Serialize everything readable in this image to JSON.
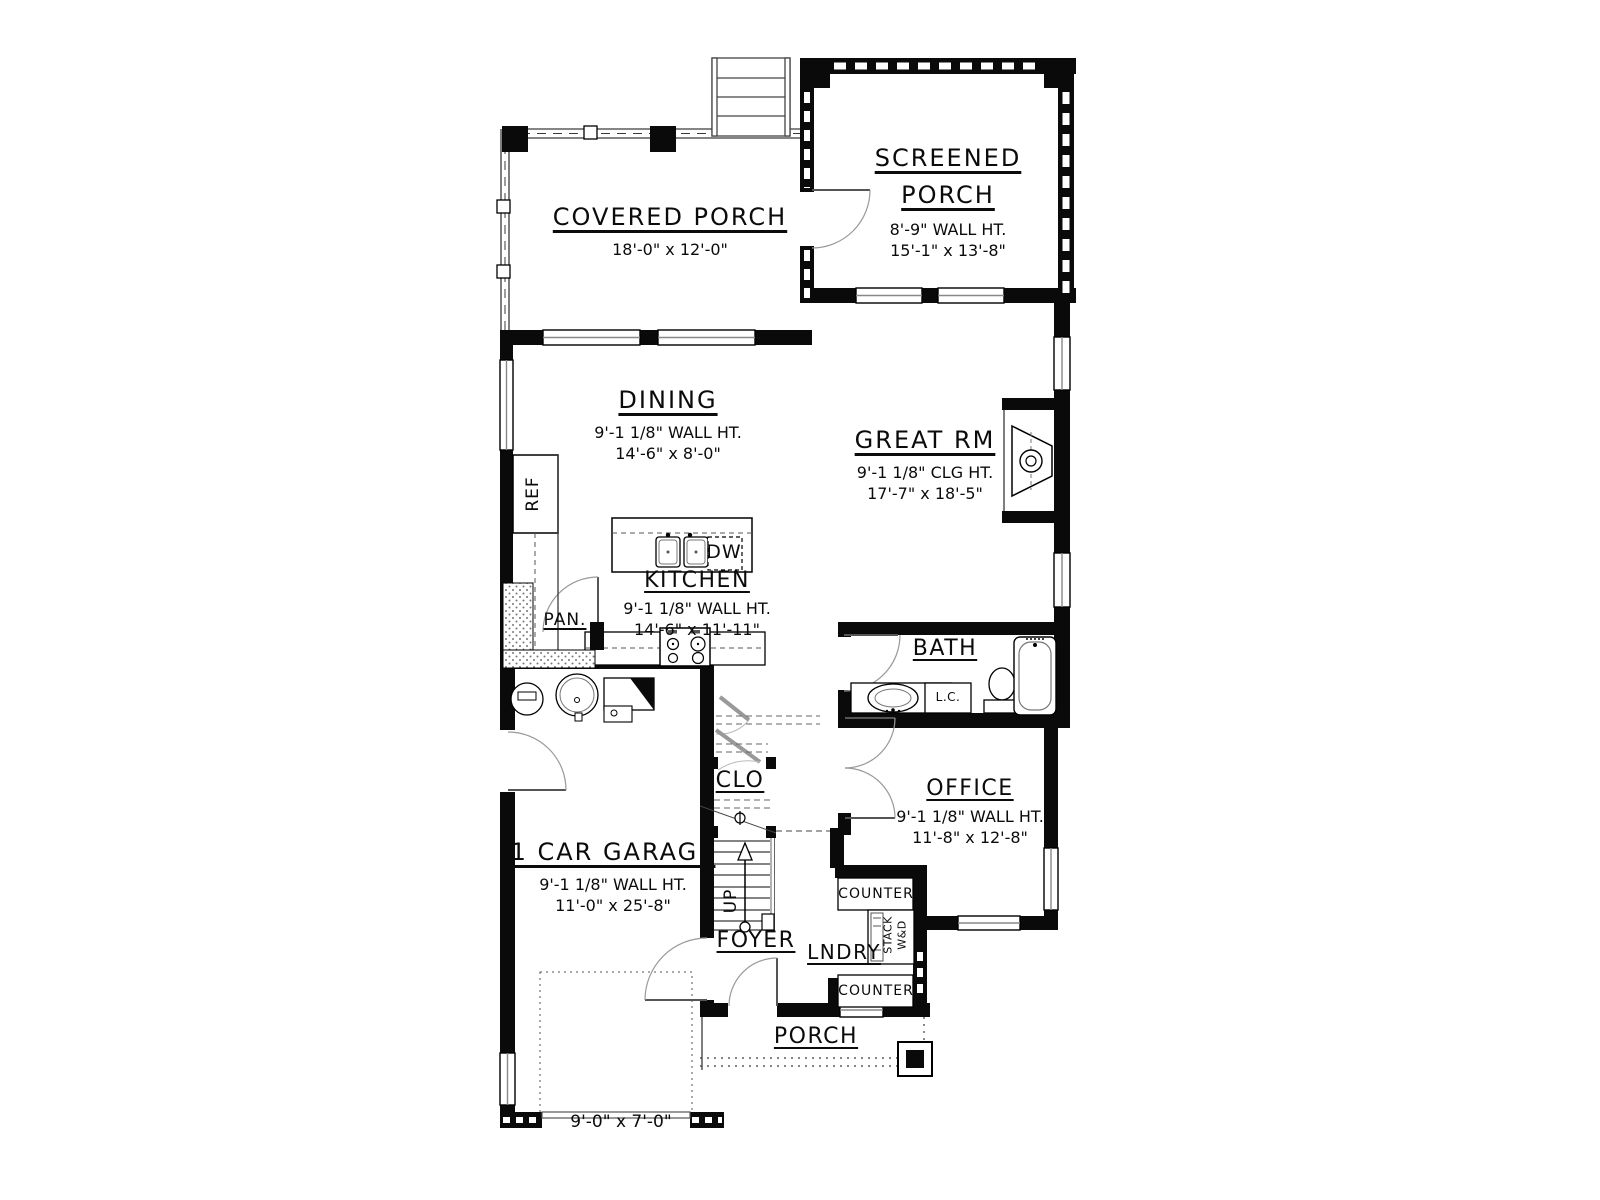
{
  "plan": {
    "rooms": {
      "covered_porch": {
        "name": "COVERED PORCH",
        "dims": "18'-0\" x 12'-0\""
      },
      "screened_porch": {
        "name": "SCREENED PORCH",
        "wall_ht": "8'-9\" WALL HT.",
        "dims": "15'-1\" x 13'-8\""
      },
      "dining": {
        "name": "DINING",
        "wall_ht": "9'-1 1/8\" WALL HT.",
        "dims": "14'-6\" x 8'-0\""
      },
      "great_rm": {
        "name": "GREAT RM",
        "clg_ht": "9'-1 1/8\" CLG HT.",
        "dims": "17'-7\" x 18'-5\""
      },
      "kitchen": {
        "name": "KITCHEN",
        "wall_ht": "9'-1 1/8\" WALL HT.",
        "dims": "14'-6\" x 11'-11\""
      },
      "bath": {
        "name": "BATH"
      },
      "office": {
        "name": "OFFICE",
        "wall_ht": "9'-1 1/8\" WALL HT.",
        "dims": "11'-8\" x 12'-8\""
      },
      "garage": {
        "name": "1 CAR GARAGE",
        "wall_ht": "9'-1 1/8\" WALL HT.",
        "dims": "11'-0\" x 25'-8\"",
        "door_dims": "9'-0\" x 7'-0\""
      },
      "foyer": {
        "name": "FOYER"
      },
      "closet": {
        "name": "CLO"
      },
      "laundry": {
        "name": "LNDRY"
      },
      "porch": {
        "name": "PORCH"
      }
    },
    "labels": {
      "ref": "REF",
      "pantry": "PAN.",
      "dishwasher": "DW",
      "linen_cabinet": "L.C.",
      "counter_upper": "COUNTER",
      "counter_lower": "COUNTER",
      "stack_wd_line1": "STACK",
      "stack_wd_line2": "W&D",
      "stairs_up": "UP"
    },
    "colors": {
      "wall": "#0a0a0a",
      "line": "#3a3a3a",
      "background": "#ffffff"
    }
  }
}
